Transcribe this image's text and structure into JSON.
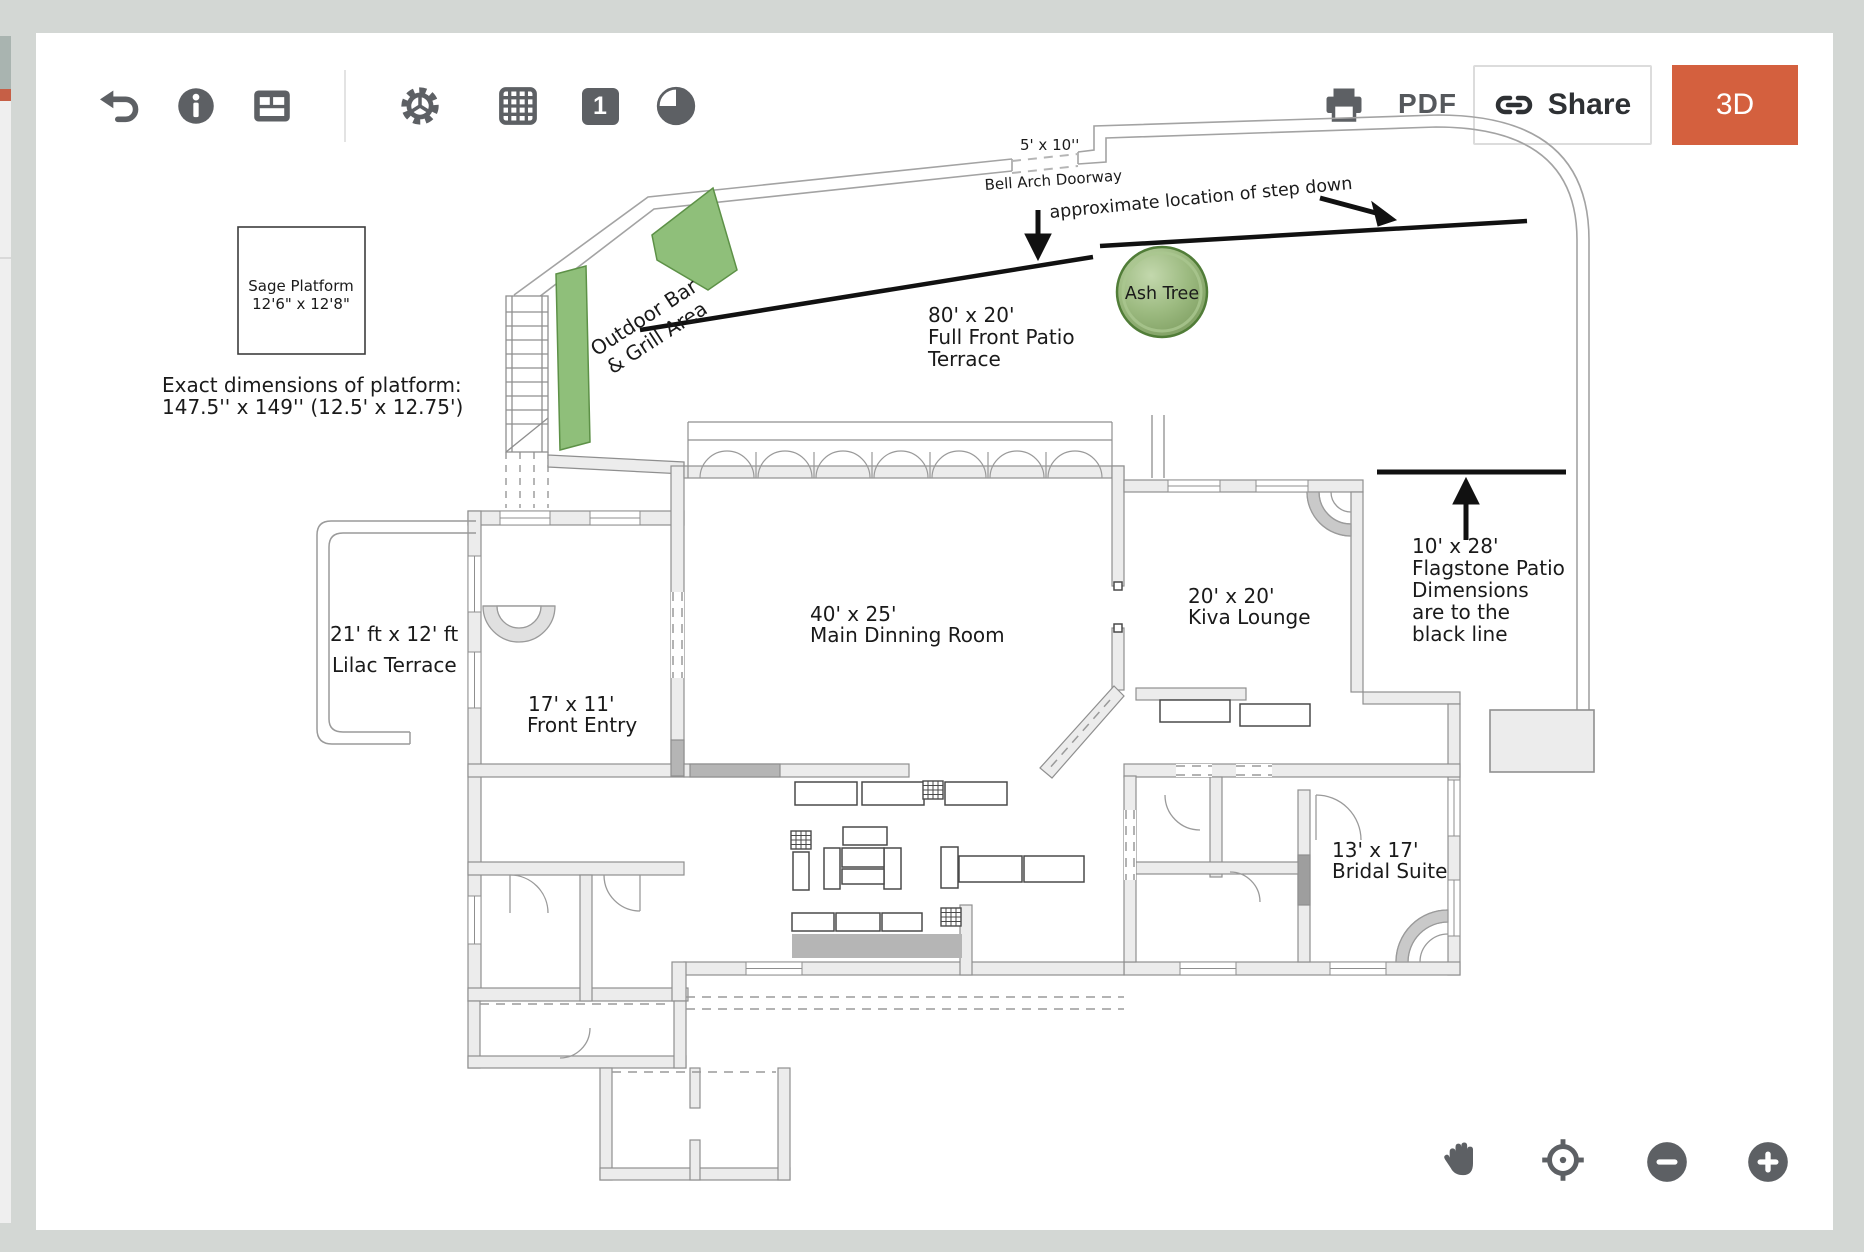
{
  "ui": {
    "toolbar": {
      "icons_left": [
        "undo",
        "info",
        "legend-card"
      ],
      "icons_middle": [
        "settings-gear",
        "grid",
        "page-1-badge",
        "pie-view"
      ],
      "page_number": "1",
      "pdf_label": "PDF",
      "share_label": "Share",
      "threed_label": "3D",
      "right_icons": [
        "print",
        "share-link"
      ]
    },
    "zoom_controls": [
      "pan-hand",
      "center-target",
      "zoom-out",
      "zoom-in"
    ],
    "colors": {
      "accent_orange": "#d4603e",
      "icon_gray": "#5d6064",
      "page_background": "#d3d7d4",
      "canvas_background": "#ffffff",
      "plan_green": "#8fbf7a",
      "wall_fill": "#ececec"
    }
  },
  "plan": {
    "sage_platform": {
      "name": "Sage Platform",
      "size": "12'6\" x 12'8\""
    },
    "platform_note": {
      "line1": "Exact dimensions of platform:",
      "line2": "147.5'' x 149'' (12.5' x 12.75')"
    },
    "bell_arch_size": "5' x 10''",
    "bell_arch_label": "Bell Arch Doorway",
    "step_down_note": "approximate location of step down",
    "outdoor_bar": {
      "line1": "Outdoor Bar",
      "line2": "& Grill Area"
    },
    "ash_tree": "Ash Tree",
    "front_patio": {
      "size": "80' x 20'",
      "line1": "Full Front Patio",
      "line2": "Terrace"
    },
    "flagstone": {
      "size": "10' x 28'",
      "line1": "Flagstone Patio",
      "line2": "Dimensions",
      "line3": "are to the",
      "line4": "black line"
    },
    "lilac_terrace": {
      "size": "21' ft x 12' ft",
      "name": "Lilac Terrace"
    },
    "front_entry": {
      "size": "17' x 11'",
      "name": "Front Entry"
    },
    "dining_room": {
      "size": "40' x 25'",
      "name": "Main Dinning Room"
    },
    "kiva_lounge": {
      "size": "20' x 20'",
      "name": "Kiva Lounge"
    },
    "bridal_suite": {
      "size": "13' x 17'",
      "name": "Bridal Suite"
    }
  }
}
